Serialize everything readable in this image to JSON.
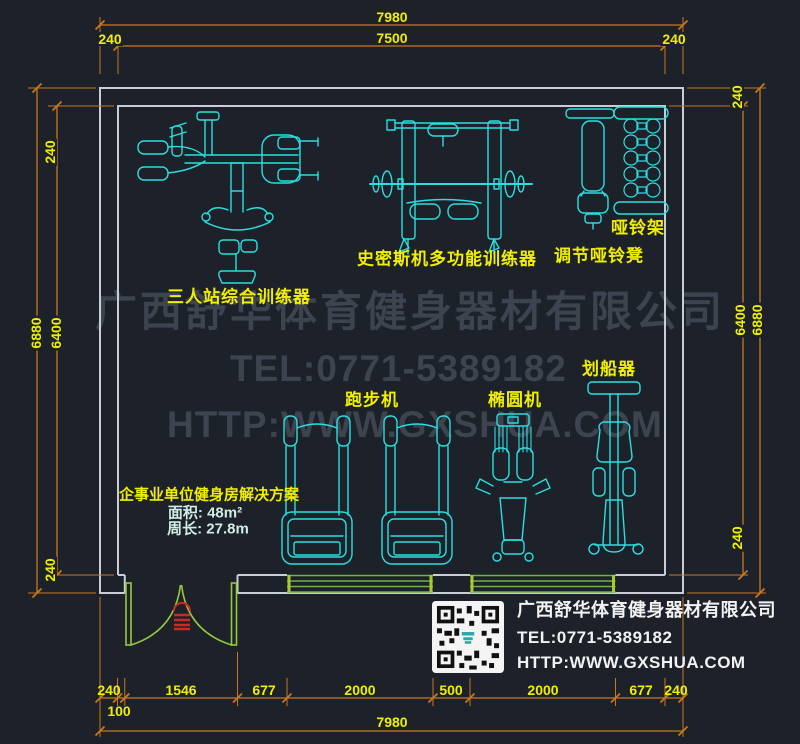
{
  "watermark": {
    "company": "广西舒华体育健身器材有限公司",
    "tel": "TEL:0771-5389182",
    "web": "HTTP:WWW.GXSHUA.COM"
  },
  "footer": {
    "company": "广西舒华体育健身器材有限公司",
    "tel": "TEL:0771-5389182",
    "web": "HTTP:WWW.GXSHUA.COM"
  },
  "solution": {
    "title": "企事业单位健身房解决方案",
    "area": "面积: 48m²",
    "perimeter": "周长: 27.8m"
  },
  "equipment": {
    "multi_gym": "三人站综合训练器",
    "smith_machine": "史密斯机多功能训练器",
    "adjustable_bench": "调节哑铃凳",
    "dumbbell_rack": "哑铃架",
    "treadmill": "跑步机",
    "elliptical": "椭圆机",
    "rower": "划船器"
  },
  "dimensions": {
    "top": {
      "overall": "7980",
      "inner": "7500",
      "left": "240",
      "right": "240"
    },
    "left": {
      "top": "240",
      "outer": "6880",
      "inner": "6400",
      "bottom": "240"
    },
    "right": {
      "top": "240",
      "inner": "6400",
      "outer": "6880",
      "bottom": "240"
    },
    "bottom": {
      "segments": [
        "240",
        "1546",
        "677",
        "2000",
        "500",
        "2000",
        "677",
        "240"
      ],
      "offset": "100",
      "overall": "7980"
    }
  },
  "colors": {
    "background": "#1d212a",
    "equipment_cyan": "#2adfdf",
    "dimension_orange": "#c9781e",
    "label_yellow": "#f0ef00",
    "wall_gray": "#c9ced6",
    "door_green": "#96c83c",
    "window_green": "#6eb43e",
    "watermark_gray": "#3d4450",
    "door_symbol_red": "#cc2a1e",
    "footer_white": "#f2f2f2"
  }
}
